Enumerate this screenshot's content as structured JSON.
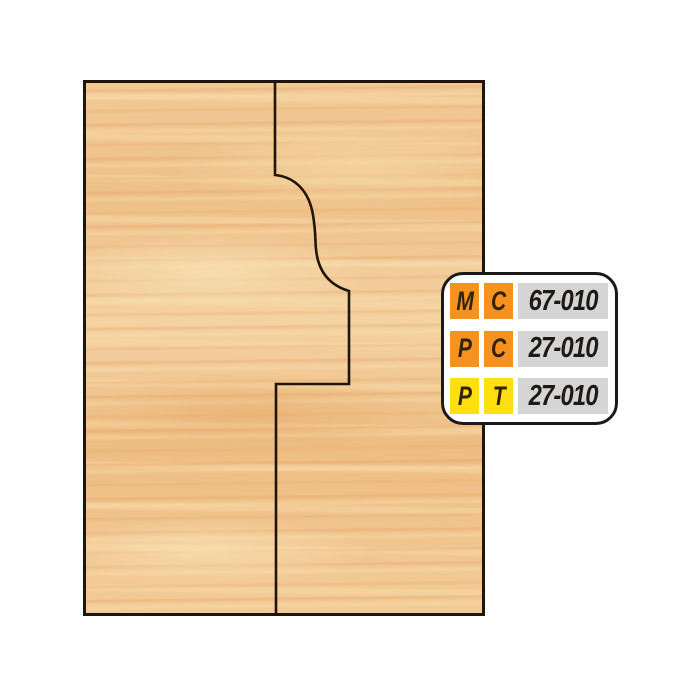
{
  "page": {
    "background": "#ffffff",
    "description": "Wood board illustration showing an ogee glue-joint cut profile with cutter part-number badge"
  },
  "wood_panel": {
    "base_color": "#f0c38c",
    "streak_light": "#f7dfb2",
    "streak_dark": "#e0985a",
    "border_color": "#20150a"
  },
  "profile": {
    "path": "M 275 80 L 275 175 C 295 177 309 191 313 215 C 316 233 315 241 316 249 C 318 271 329 285 349 291 L 349 384 L 276 384 L 276 616",
    "stroke_color": "#20150a"
  },
  "badge": {
    "background": "#ffffff",
    "border_color": "#1a1a1a",
    "code_background": "#d5d5d6",
    "orange": "#f6921e",
    "yellow": "#ffdf10",
    "rows": [
      {
        "letter1": "M",
        "letter2": "C",
        "code": "67-010",
        "color": "#f6921e"
      },
      {
        "letter1": "P",
        "letter2": "C",
        "code": "27-010",
        "color": "#f6921e"
      },
      {
        "letter1": "P",
        "letter2": "T",
        "code": "27-010",
        "color": "#ffdf10"
      }
    ]
  }
}
